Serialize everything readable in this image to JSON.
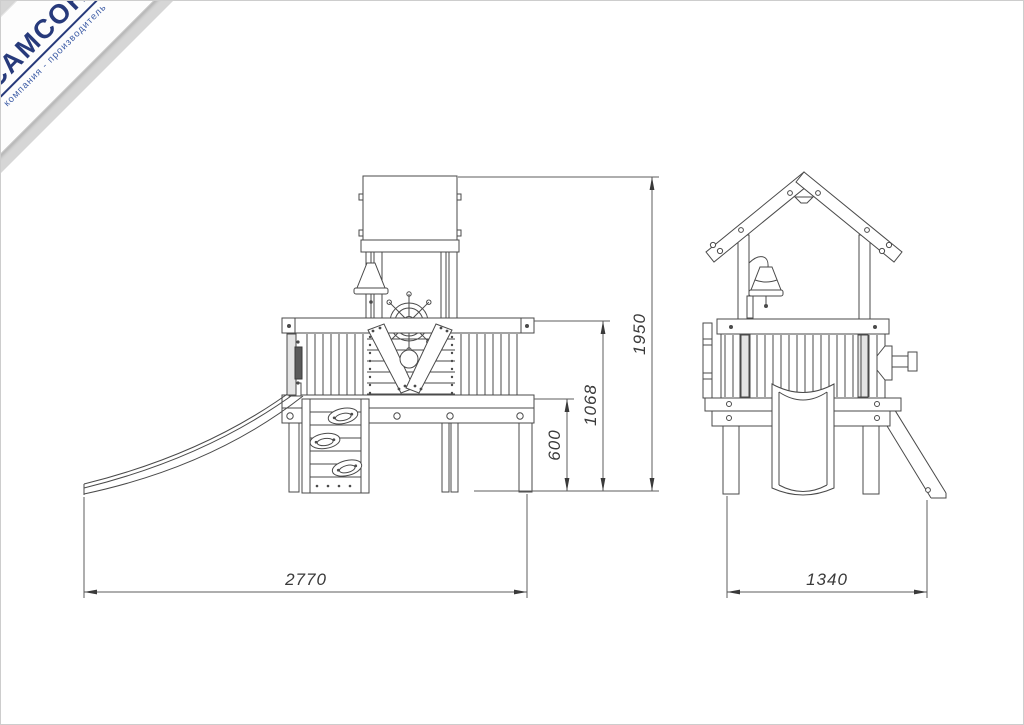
{
  "page": {
    "background": "#ffffff",
    "border_color": "#cdcdcd"
  },
  "logo": {
    "brand": "САМСОН",
    "tagline": "компания - производитель",
    "brand_color": "#273a7b",
    "tagline_color": "#3d5ca6",
    "accent_red": "#cc2027",
    "corner_bg": "#d6d6d6",
    "ribbon_bg": "#ffffff"
  },
  "drawing": {
    "subject": "playground tower with slide, bell, ship wheel and climbing wall — two orthographic views",
    "line_color": "#4a4a4a",
    "dimension_color": "#3a3a3a",
    "side_view": {
      "name": "side elevation",
      "dim_width": "2770",
      "dim_height_total": "1950",
      "dim_height_railing": "1068",
      "dim_height_deck": "600"
    },
    "front_view": {
      "name": "front elevation",
      "dim_width": "1340"
    }
  }
}
